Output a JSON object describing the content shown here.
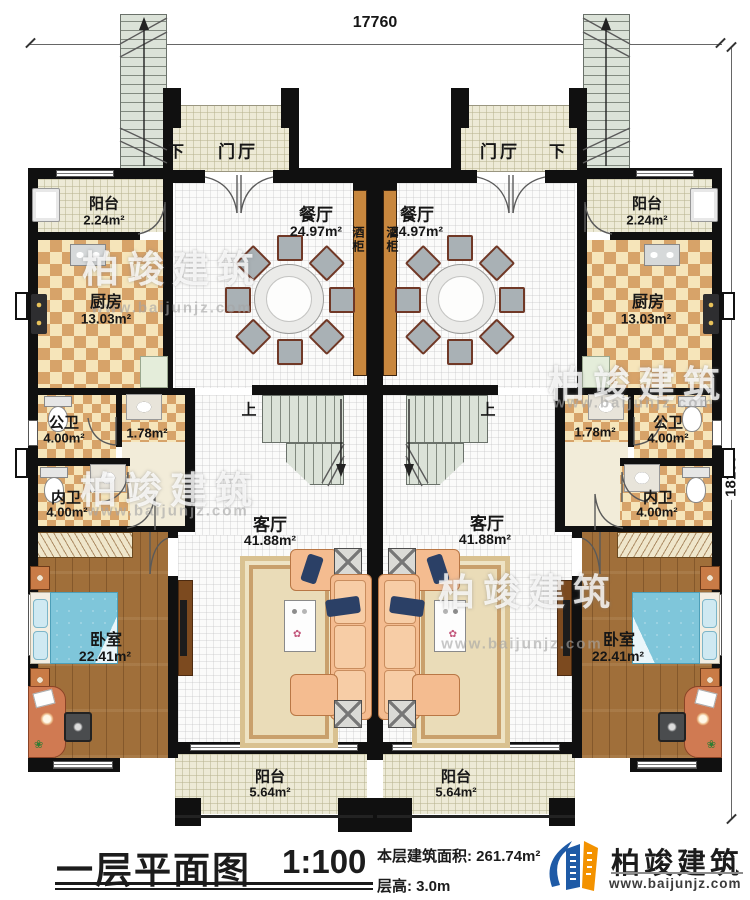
{
  "dimensions": {
    "top": "17760",
    "right": "18100"
  },
  "labels": {
    "entry": "门厅",
    "down": "下",
    "up": "上",
    "balcony": "阳台",
    "balcony_top_area": "2.24m²",
    "dining": "餐厅",
    "dining_area": "24.97m²",
    "wine_cabinet": "酒柜",
    "kitchen": "厨房",
    "kitchen_area": "13.03m²",
    "public_bath": "公卫",
    "public_bath_area": "4.00m²",
    "wash_area": "1.78m²",
    "private_bath": "内卫",
    "private_bath_area": "4.00m²",
    "living": "客厅",
    "living_area": "41.88m²",
    "bedroom": "卧室",
    "bedroom_area": "22.41m²",
    "balcony_bottom_area": "5.64m²"
  },
  "title_block": {
    "title": "一层平面图",
    "scale": "1:100",
    "floor_area_label": "本层建筑面积: 261.74m²",
    "floor_height_label": "层高: 3.0m"
  },
  "brand": {
    "name": "柏竣建筑",
    "website": "www.baijunjz.com"
  },
  "watermark": {
    "name": "柏竣建筑",
    "website": "www.baijunjz.com"
  },
  "colors": {
    "wall": "#101010",
    "brand_blue": "#1e5aa6",
    "brand_orange": "#f39200",
    "checker_dark": "#d7a369",
    "checker_light": "#f6e5ba",
    "wood": "#a06f3a",
    "bed_blue": "#7fc6da",
    "sofa_peach": "#f4bc90"
  }
}
